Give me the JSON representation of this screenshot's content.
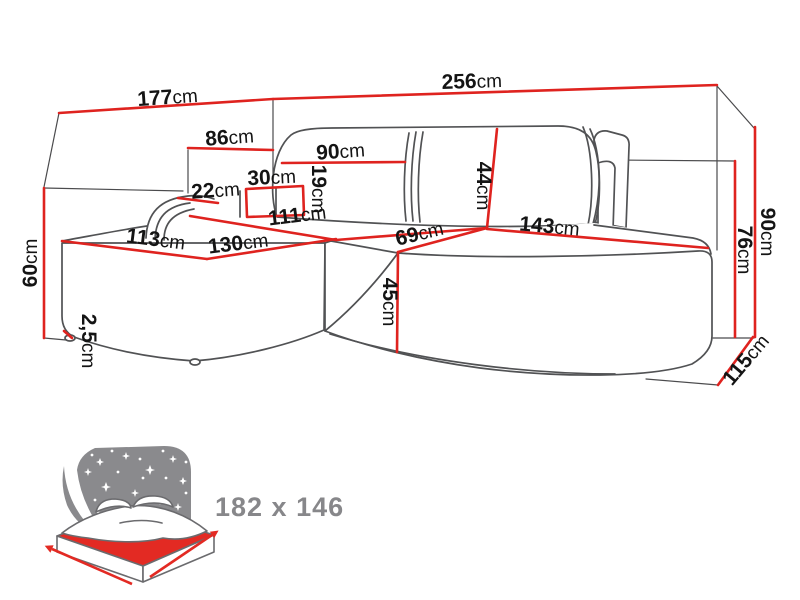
{
  "diagram": {
    "title": "corner-sofa-dimension-diagram",
    "unit": "cm",
    "dimensions": {
      "back_width_left": {
        "value": "177",
        "unit": "cm"
      },
      "back_width_right": {
        "value": "256",
        "unit": "cm"
      },
      "armrest_back_offset": {
        "value": "86",
        "unit": "cm"
      },
      "backrest_cushion_left": {
        "value": "90",
        "unit": "cm"
      },
      "armrest_top_width": {
        "value": "30",
        "unit": "cm"
      },
      "armrest_roll_width": {
        "value": "22",
        "unit": "cm"
      },
      "armrest_height": {
        "value": "19",
        "unit": "cm"
      },
      "chaise_back_depth": {
        "value": "111",
        "unit": "cm"
      },
      "chaise_front_width": {
        "value": "113",
        "unit": "cm"
      },
      "chaise_inner_width": {
        "value": "130",
        "unit": "cm"
      },
      "corner_seat_width": {
        "value": "69",
        "unit": "cm"
      },
      "seat_width_right": {
        "value": "143",
        "unit": "cm"
      },
      "backrest_cushion_height": {
        "value": "44",
        "unit": "cm"
      },
      "seat_front_height": {
        "value": "45",
        "unit": "cm"
      },
      "chaise_height": {
        "value": "60",
        "unit": "cm"
      },
      "foot_height": {
        "value": "2,5",
        "unit": "cm"
      },
      "total_height": {
        "value": "90",
        "unit": "cm"
      },
      "back_panel_height": {
        "value": "76",
        "unit": "cm"
      },
      "side_depth": {
        "value": "115",
        "unit": "cm"
      }
    },
    "sleeping_area": {
      "label": "182 x 146"
    },
    "colors": {
      "dimension_line": "#df231f",
      "outline_gray": "#515254",
      "helper_gray": "#4b4b4d",
      "label_black": "#141414",
      "icon_gray": "#8a8a8d",
      "icon_red": "#e32a23",
      "sleeping_text_gray": "#87878a"
    }
  }
}
